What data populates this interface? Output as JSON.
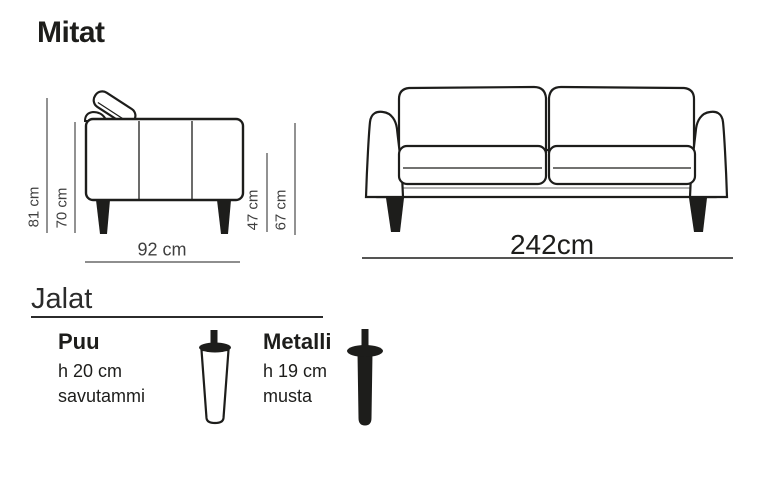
{
  "title": "Mitat",
  "side_view": {
    "label_total_height": "81 cm",
    "label_body_height": "70 cm",
    "label_seat_height": "47 cm",
    "label_arm_height": "67 cm",
    "label_depth": "92 cm"
  },
  "front_view": {
    "label_width": "242cm"
  },
  "legs": {
    "heading": "Jalat",
    "options": [
      {
        "name": "Puu",
        "height": "h 20 cm",
        "finish": "savutammi",
        "icon": "wood-leg-icon"
      },
      {
        "name": "Metalli",
        "height": "h 19 cm",
        "finish": "musta",
        "icon": "metal-leg-icon"
      }
    ]
  },
  "colors": {
    "line": "#1d1d1b",
    "dimension_text": "#3f3f3f",
    "base_accent": "#9a9a9a",
    "background": "#ffffff"
  }
}
